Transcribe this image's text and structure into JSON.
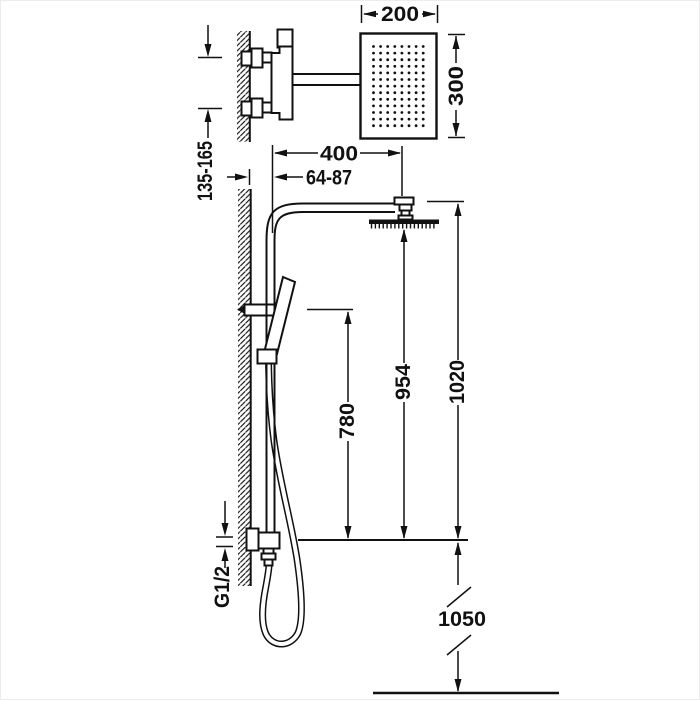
{
  "title": "Shower column technical dimension drawing",
  "dims": {
    "head_width": "200",
    "head_depth": "300",
    "projection": "400",
    "riser_offset": "64-87",
    "inlet_spacing": "135-165",
    "handle_height": "780",
    "spray_face_height": "954",
    "overall_height": "1020",
    "supply_height": "1050",
    "thread": "G1/2"
  },
  "showerhead": {
    "spray_dot_columns": 8,
    "spray_dot_rows": 13,
    "side_nozzle_ticks": 17
  },
  "colors": {
    "line": "#111111",
    "background": "#ffffff"
  }
}
